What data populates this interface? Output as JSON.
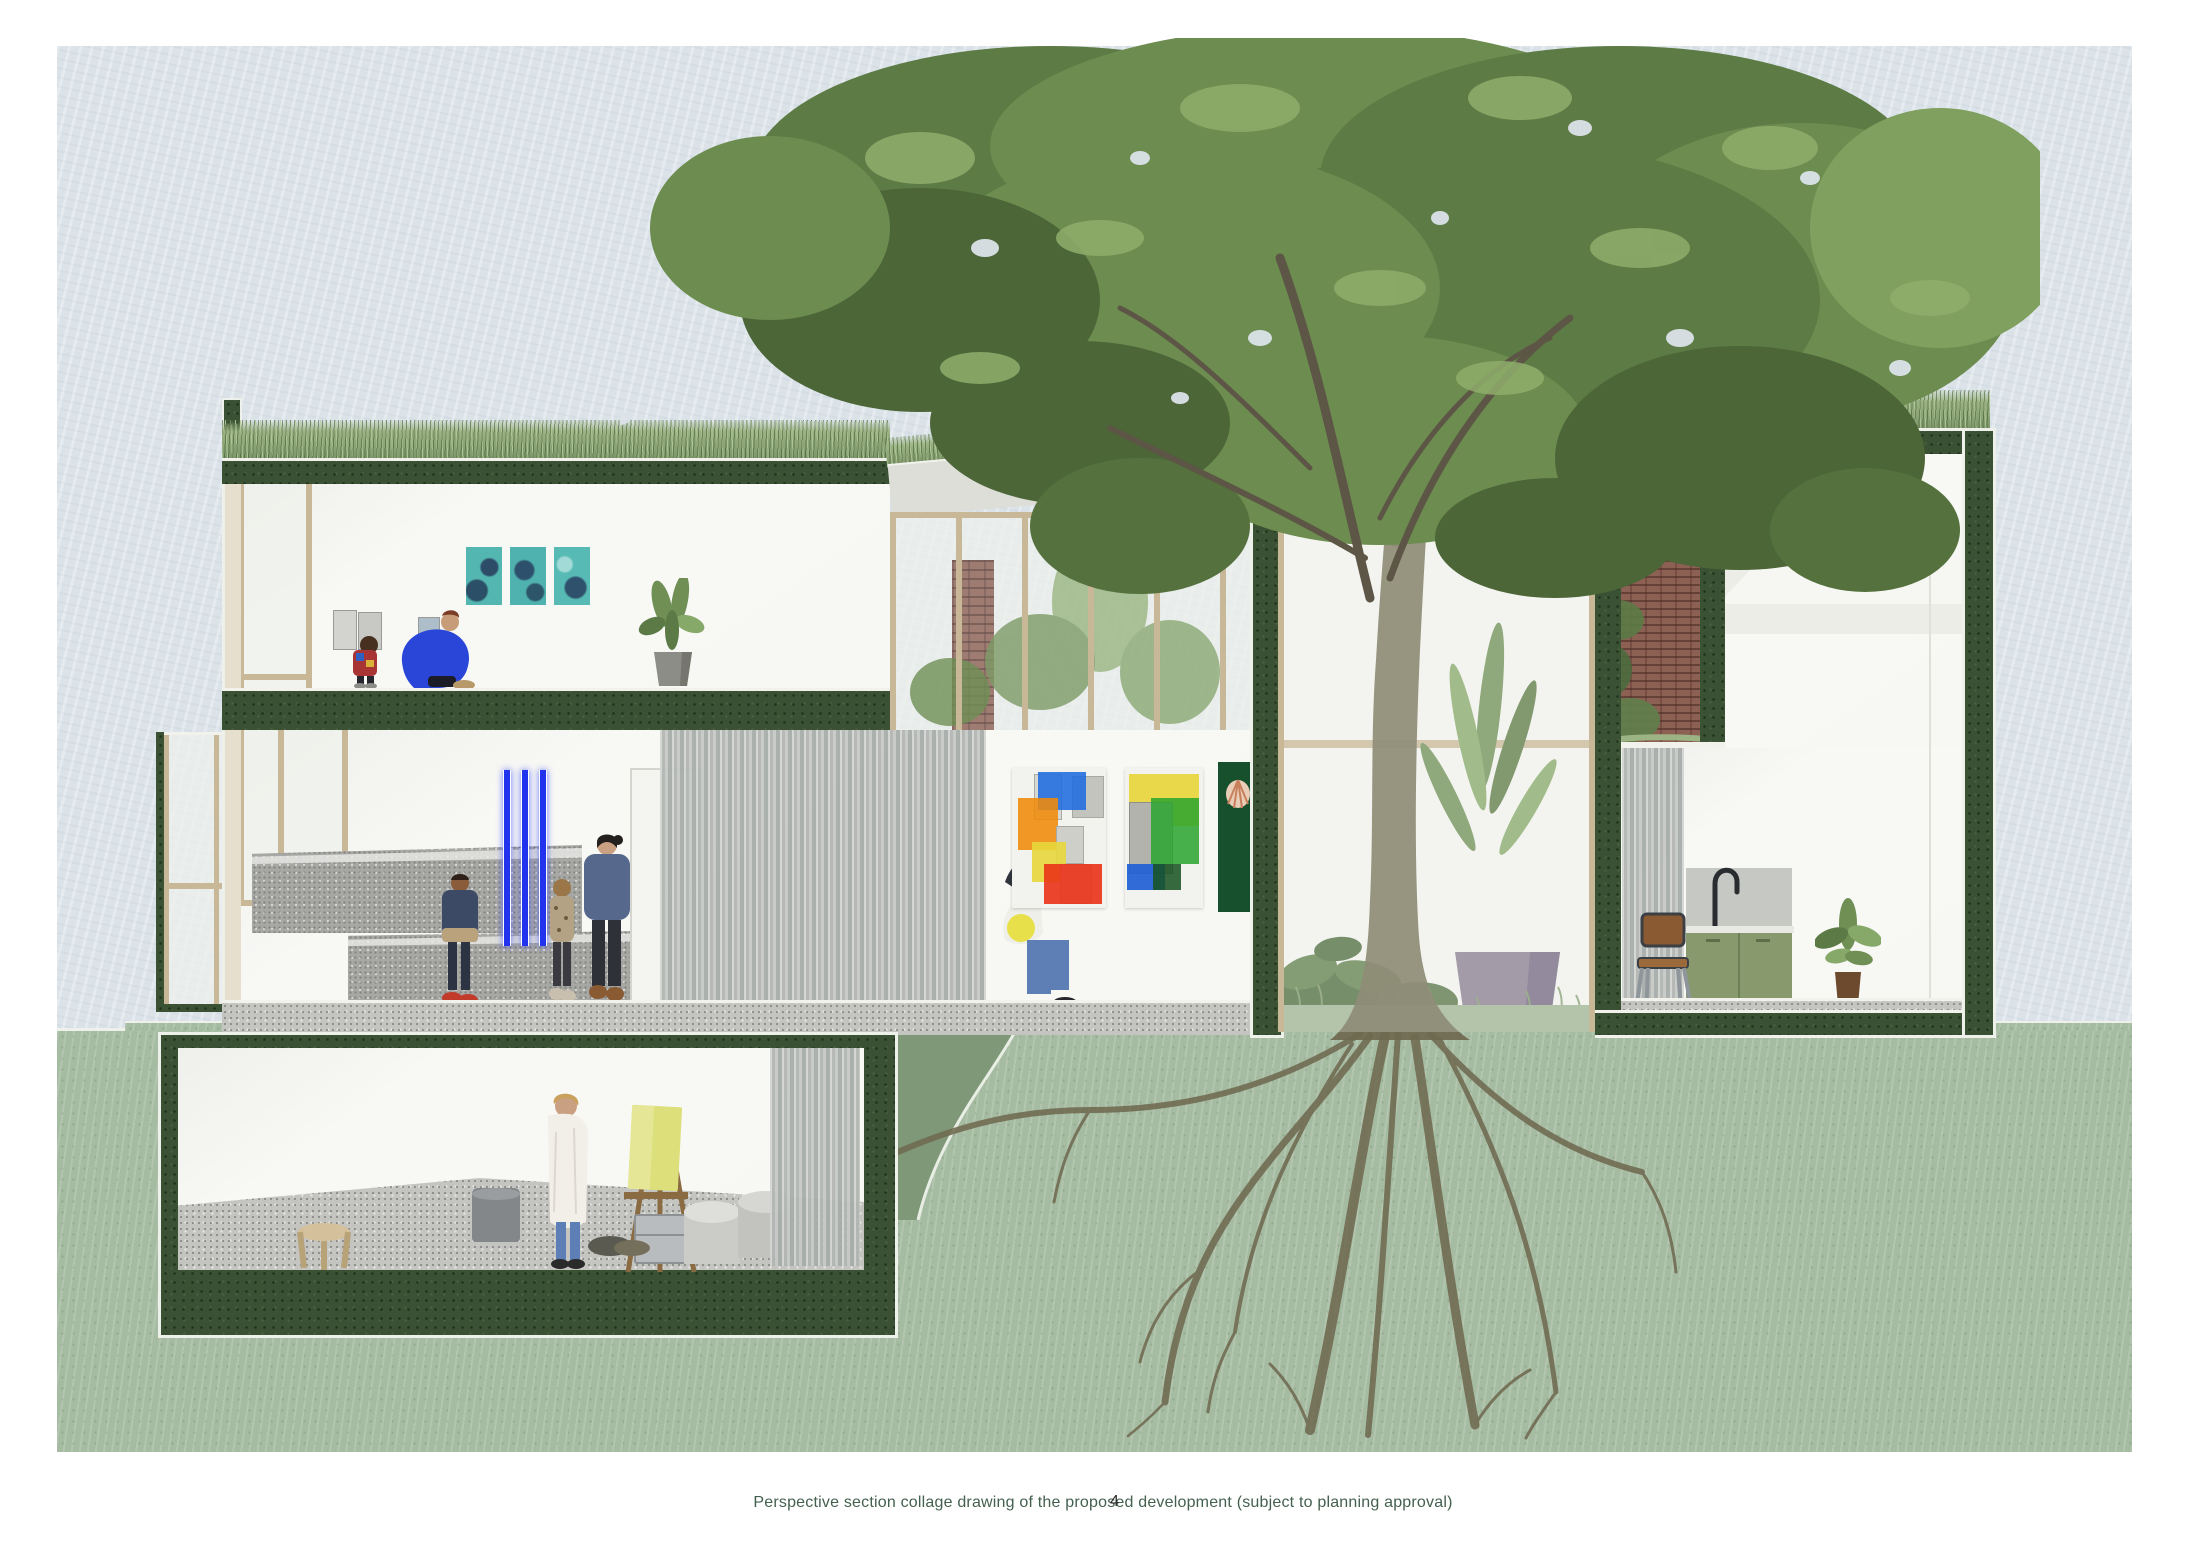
{
  "document": {
    "caption": "Perspective section collage drawing of the proposed development (subject to planning approval)",
    "page_number": "4"
  },
  "palette": {
    "sky": "#dbe3e9",
    "ground_light": "#a6bca2",
    "ground_medium": "#7e9878",
    "section_cut_green": "#3a5133",
    "interior_white": "#f7f7f4",
    "grass_green": "#8ea877",
    "foliage_dark": "#4c6638",
    "foliage_mid": "#6c8c50",
    "foliage_light": "#7fa05e",
    "trunk_olive": "#6e6950",
    "window_frame_tan": "#c9b897",
    "curtain_grey": "#b5b8b5",
    "kitchen_cabinet_green": "#87996d",
    "plant_pot_purple": "#8a7d92",
    "brick_red": "#8d6054",
    "artwork_teal": "#54b6b0",
    "artwork_blue": "#1f6be0",
    "artwork_orange": "#f08a0a",
    "artwork_yellow": "#e7d63c",
    "artwork_red": "#ea3317",
    "artwork_green": "#2aa52e",
    "neon_blue": "#2233ee",
    "caption_green": "#44604f"
  },
  "scene": {
    "type": "architectural-perspective-section-collage",
    "spaces": [
      "roof-garden",
      "top-floor-gallery",
      "ground-floor-gallery",
      "conservatory",
      "courtyard-with-tree",
      "kitchen-room",
      "basement-art-studio",
      "tree-root-system"
    ]
  }
}
